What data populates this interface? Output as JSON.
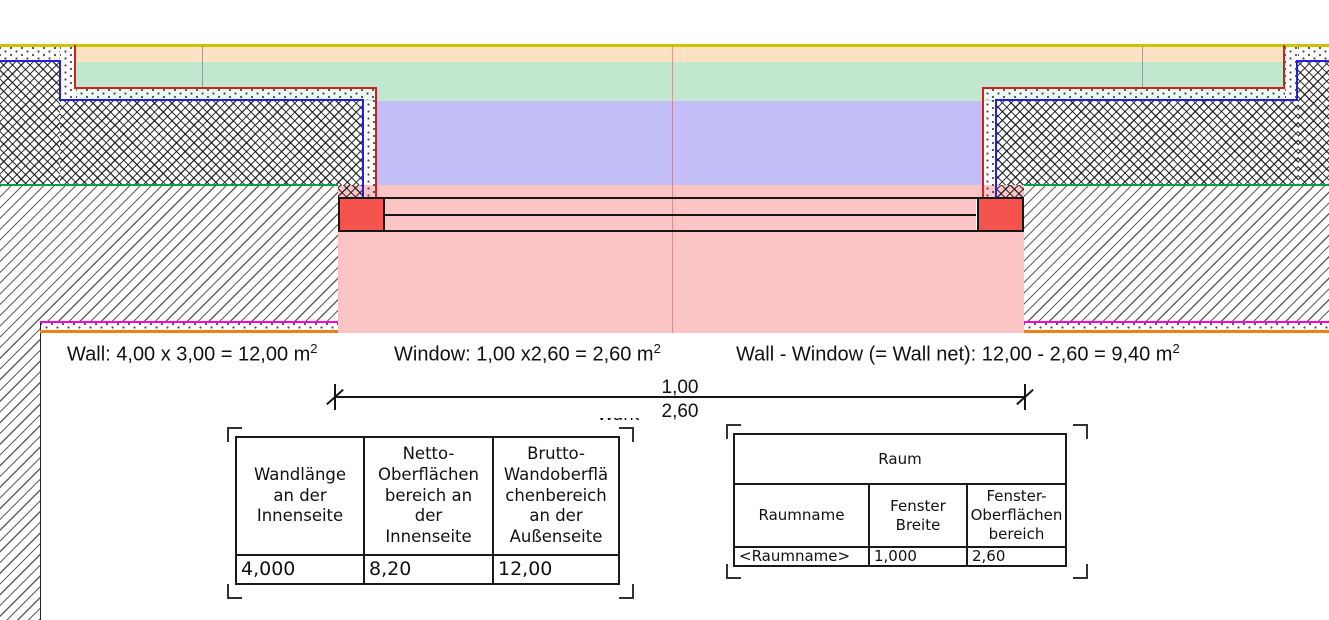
{
  "formulas": [
    {
      "text": "Wall: 4,00 x 3,00 = 12,00 m",
      "sup": "2"
    },
    {
      "text": "Window: 1,00 x2,60 = 2,60 m",
      "sup": "2"
    },
    {
      "text": "Wall - Window (= Wall net): 12,00 - 2,60 = 9,40 m",
      "sup": "2"
    }
  ],
  "dimension": {
    "top_label": "1,00",
    "bottom_label": "2,60"
  },
  "clipped_label": "Wand",
  "wall_table": {
    "headers": [
      "Wandlänge\nan der\nInnenseite",
      "Netto-\nOberflächen\nbereich an\nder\nInnenseite",
      "Brutto-\nWandoberflä\nchenbereich\nan der\nAußenseite"
    ],
    "values": [
      "4,000",
      "8,20",
      "12,00"
    ]
  },
  "room_table": {
    "title": "Raum",
    "headers": [
      "Raumname",
      "Fenster\nBreite",
      "Fenster-\nOberflächen\nbereich"
    ],
    "values": [
      "<Raumname>",
      "1,000",
      "2,60"
    ]
  },
  "colors": {
    "roof_line_yellow": "#cdc300",
    "band_orange": "#fde2c4",
    "band_green": "#c1e7cf",
    "band_purple": "#c3bef8",
    "zone_pink": "#fbc5c6",
    "window_jamb_red": "#f4534e",
    "outline_red": "#cf1f1f",
    "outline_blue": "#2220dd",
    "floor_line_green": "#00a14b",
    "slab_line_magenta": "#ff00dd",
    "slab_line_orange": "#ee7f1b"
  }
}
